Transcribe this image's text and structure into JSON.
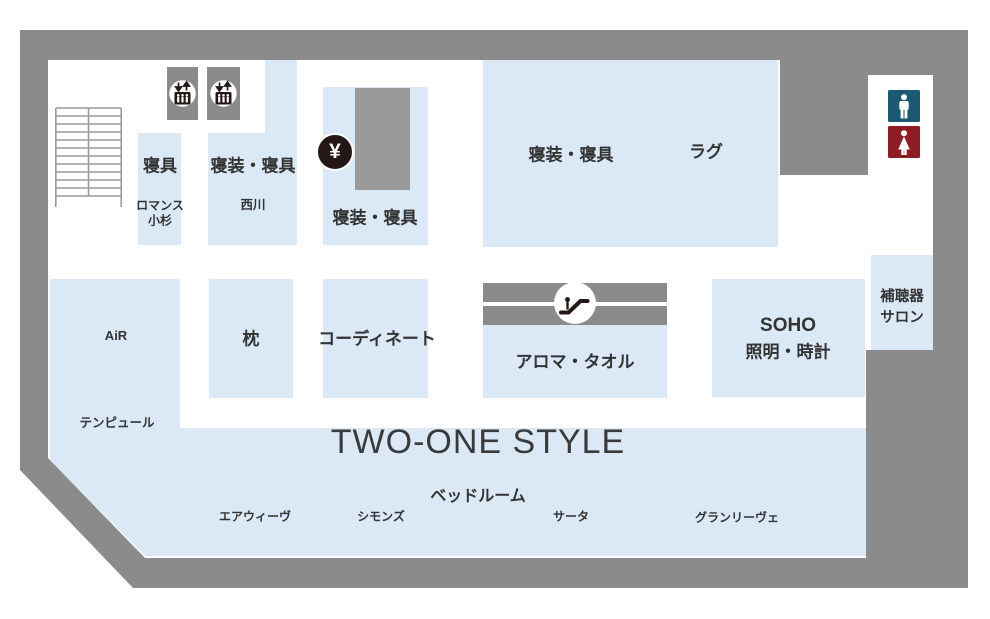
{
  "map_type": "department-store-floor-map",
  "colors": {
    "wall": "#8b8b8b",
    "area_fill": "#dbe9f7",
    "pillar": "#9a9a9a",
    "mens_restroom": "#1c5a73",
    "womens_restroom": "#8e1c24",
    "text": "#333333",
    "icon_black": "#231815"
  },
  "areas": {
    "bedding_small": {
      "label": "寝具",
      "tenant_line1": "ロマンス",
      "tenant_line2": "小杉"
    },
    "bedding_nishikawa": {
      "label": "寝装・寝具",
      "tenant": "西川"
    },
    "bedding_center": {
      "label": "寝装・寝具"
    },
    "bedding_rug": {
      "label": "寝装・寝具",
      "label2": "ラグ"
    },
    "air": {
      "label": "AiR",
      "tenant": "テンピュール"
    },
    "pillow": {
      "label": "枕"
    },
    "coordinate": {
      "label": "コーディネート"
    },
    "aroma_towel": {
      "label": "アロマ・タオル"
    },
    "soho": {
      "line1": "SOHO",
      "line2": "照明・時計"
    },
    "hearing_aid": {
      "line1": "補聴器",
      "line2": "サロン"
    },
    "two_one_style": {
      "title": "TWO-ONE STYLE",
      "subtitle": "ベッドルーム",
      "brands": [
        "エアウィーヴ",
        "シモンズ",
        "サータ",
        "グランリーヴェ"
      ]
    }
  },
  "icons": {
    "yen_symbol": "¥",
    "elevator": "elevator-icon",
    "escalator": "escalator-icon",
    "stairs": "stairs-icon",
    "mens_restroom": "mens-restroom-icon",
    "womens_restroom": "womens-restroom-icon",
    "cash_register": "cash-register-icon"
  }
}
